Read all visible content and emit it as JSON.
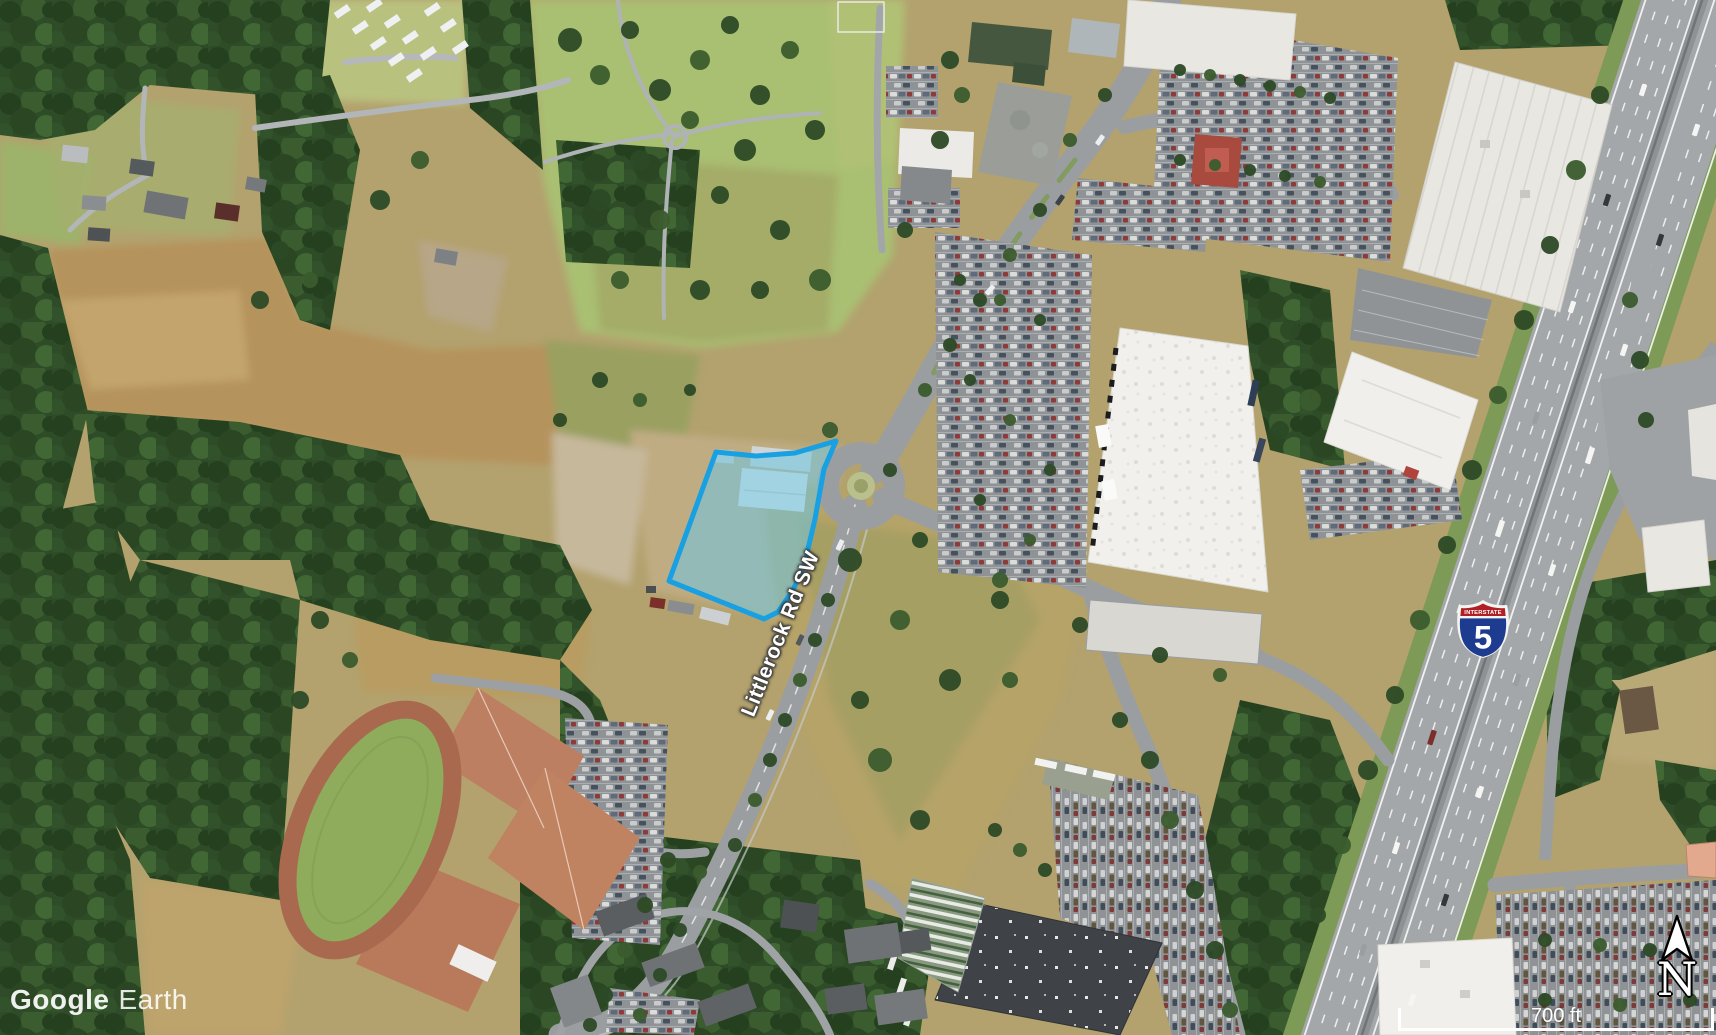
{
  "watermark": {
    "brand": "Google",
    "product": "Earth"
  },
  "overlays": {
    "road_label": "Littlerock Rd SW",
    "shield": {
      "top_text": "INTERSTATE",
      "route_number": "5"
    },
    "compass": {
      "north_label": "N"
    },
    "scale_bar": {
      "distance_label": "700 ft"
    }
  },
  "parcel": {
    "fill_color": "#6ec6e0",
    "fill_opacity": "0.55",
    "border_color": "#18a0e3"
  },
  "shield_colors": {
    "field_blue": "#1d3b8f",
    "band_red": "#b01f24"
  }
}
